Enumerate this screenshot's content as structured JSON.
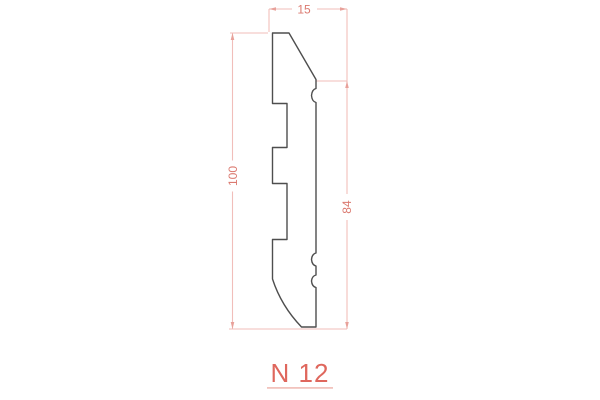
{
  "drawing": {
    "title": "N 12",
    "dimensions": {
      "top_width": "15",
      "total_height": "100",
      "face_height": "84"
    },
    "colors": {
      "dimension_line": "#f1beba",
      "dimension_text": "#db7a70",
      "arrow": "#e8a19a",
      "label_text": "#df675d",
      "label_underline": "#f2c3bd",
      "profile_line": "#4e4e4e",
      "background": "#ffffff"
    }
  }
}
